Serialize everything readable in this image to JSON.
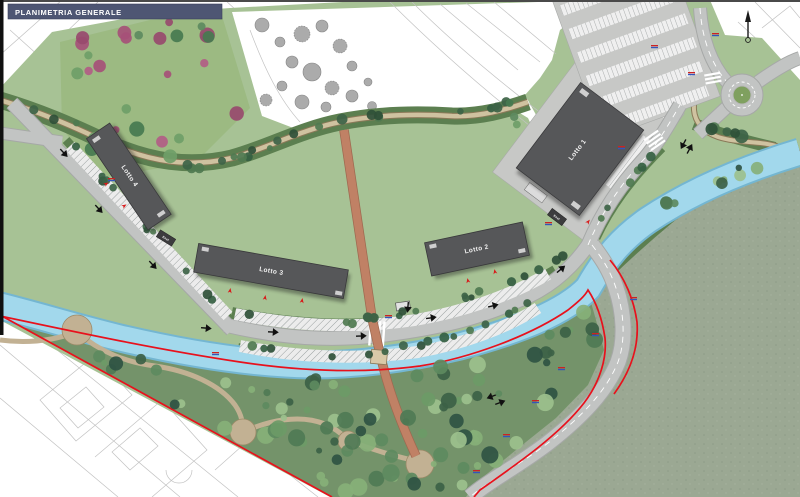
{
  "title_bar": {
    "label": "PLANIMETRIA GENERALE"
  },
  "buildings": [
    {
      "id": "lotto1",
      "label": "Lotto 1"
    },
    {
      "id": "lotto2",
      "label": "Lotto 2"
    },
    {
      "id": "lotto3",
      "label": "Lotto 3"
    },
    {
      "id": "lotto4",
      "label": "Lotto 4"
    }
  ],
  "cabins": [
    {
      "label": "Enel"
    },
    {
      "label": "Enel"
    }
  ],
  "icons": {
    "north_arrow": "north-arrow"
  },
  "palette": {
    "title_bar_bg": "#4e5673",
    "lawn": "#a7c295",
    "orchard": "#9cba82",
    "park": "#74936a",
    "field": "#9ba893",
    "band_green": "#5c7f50",
    "river": "#a2d8ec",
    "river_edge": "#74b6d1",
    "road": "#c2c4c3",
    "road_edge": "#a6a8a7",
    "path_tan": "#cfc2a0",
    "path_tan_edge": "#8a7958",
    "path_terracotta": "#c08165",
    "path_terracotta_edge": "#9e6950",
    "building": "#565759",
    "building_edge": "#39393b",
    "boundary_red": "#e8111c",
    "marker_red": "#cc2222",
    "marker_blue": "#3355bb",
    "trees_park": [
      "#4f7a55",
      "#3c6147",
      "#6d9a67",
      "#87b078",
      "#2f5243",
      "#5d8a5f",
      "#9cc08d"
    ],
    "trees_dark": [
      "#3d6347",
      "#2f5038",
      "#4f7a50",
      "#356042"
    ],
    "trees_orchard_green": [
      "#5d8a5f",
      "#477a50",
      "#6f9e68"
    ],
    "trees_magenta": [
      "#a65078",
      "#b25d85",
      "#984a6e"
    ],
    "trees_gray": "#ababab"
  }
}
